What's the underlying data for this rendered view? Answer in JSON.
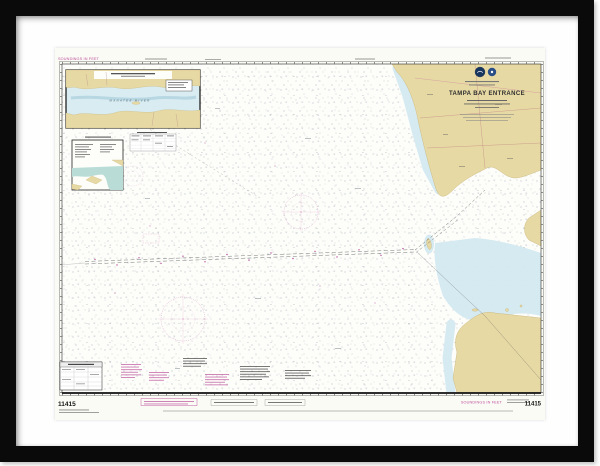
{
  "scene": {
    "description": "Framed nautical chart print hanging on white background",
    "background_color": "#ffffff",
    "frame_color": "#0a0a0a",
    "mat_color": "#fefefe"
  },
  "chart": {
    "number": "11415",
    "title": "TAMPA BAY ENTRANCE",
    "soundings_label": "SOUNDINGS IN FEET",
    "inset_label": "MANATEE RIVER",
    "paper_color": "#fbfbf6",
    "colors": {
      "land": "#e7d9a4",
      "shallow_water": "#d4e9f1",
      "inset_water": "#b9dcd6",
      "magenta": "#bc4f9b",
      "sounding_dots": "#74838e",
      "border_ink": "#222222"
    }
  }
}
